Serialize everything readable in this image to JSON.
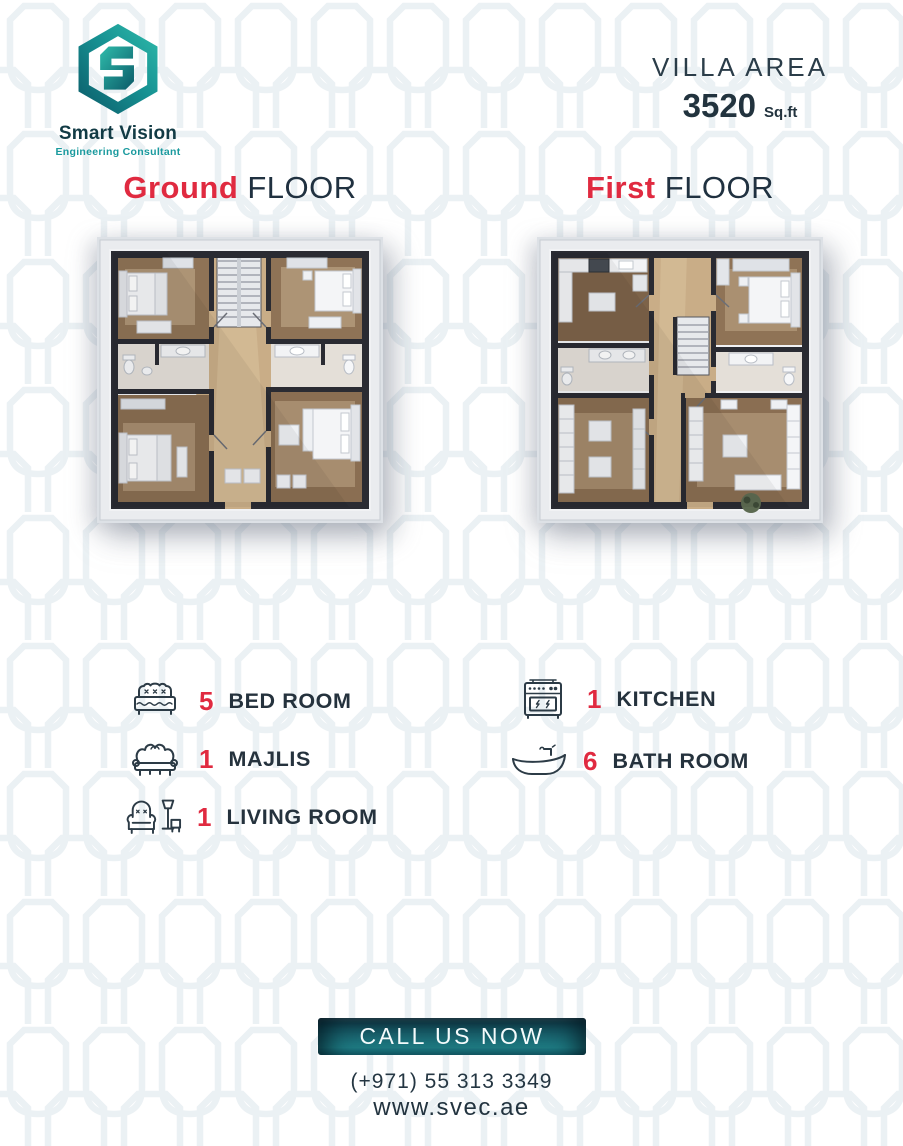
{
  "brand": {
    "name": "Smart Vision",
    "tagline": "Engineering Consultant",
    "logo_icon": "hexagon-s-logo"
  },
  "villa": {
    "label": "VILLA AREA",
    "area": "3520",
    "unit": "Sq.ft"
  },
  "floors": [
    {
      "highlight": "Ground",
      "rest": " FLOOR",
      "plan": "ground-floor-plan"
    },
    {
      "highlight": "First",
      "rest": " FLOOR",
      "plan": "first-floor-plan"
    }
  ],
  "features": {
    "left": [
      {
        "icon": "bed-icon",
        "count": "5",
        "label": "BED ROOM"
      },
      {
        "icon": "sofa-icon",
        "count": "1",
        "label": "MAJLIS"
      },
      {
        "icon": "armchair-icon",
        "count": "1",
        "label": "LIVING ROOM"
      }
    ],
    "right": [
      {
        "icon": "stove-icon",
        "count": "1",
        "label": "KITCHEN"
      },
      {
        "icon": "bathtub-icon",
        "count": "6",
        "label": "BATH ROOM"
      }
    ]
  },
  "cta": {
    "label": "CALL US NOW"
  },
  "contact": {
    "phone": "(+971) 55 313 3349",
    "website": "www.svec.ae"
  },
  "colors": {
    "accent_red": "#e02a40",
    "navy": "#243642",
    "teal_dark": "#0d5f6b",
    "teal_light": "#2ab4a9",
    "pattern": "#e8eef2"
  }
}
